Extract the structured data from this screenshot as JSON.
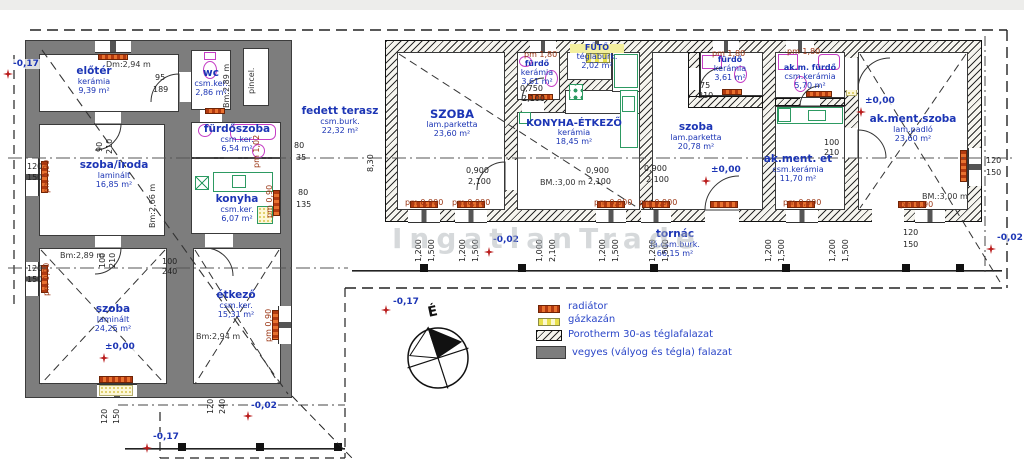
{
  "title": {
    "watermark": "IngatlanTrade",
    "north": "É"
  },
  "legend": {
    "radiator": "radiátor",
    "boiler": "gázkazán",
    "brick": "Porotherm 30-as téglafalazat",
    "mixed": "vegyes (vályog és tégla) falazat"
  },
  "rooms": {
    "eloter": {
      "name": "előtér",
      "mat": "kerámia",
      "area": "9,39 m²"
    },
    "wc": {
      "name": "wc",
      "mat": "csm.ker.",
      "area": "2,86 m²"
    },
    "pince": {
      "name": "pincel."
    },
    "furdoszoba": {
      "name": "fürdőszoba",
      "mat": "csm.ker.",
      "area": "6,54 m²"
    },
    "szoba_iroda": {
      "name": "szoba/iroda",
      "mat": "laminált",
      "area": "16,85 m²"
    },
    "konyha": {
      "name": "konyha",
      "mat": "csm.ker.",
      "area": "6,07 m²"
    },
    "szoba_nagy": {
      "name": "szoba",
      "mat": "laminált",
      "area": "24,25 m²"
    },
    "etkezo": {
      "name": "étkező",
      "mat": "csm.ker.",
      "area": "15,31 m²"
    },
    "szoba1": {
      "name": "SZOBA",
      "mat": "lam.parketta",
      "area": "23,60 m²"
    },
    "furdo1": {
      "name": "fürdő",
      "mat": "kerámia",
      "area": "3,61 m²"
    },
    "futo": {
      "name": "FŰTŐ",
      "mat": "téglaburk.",
      "area": "2,02 m²"
    },
    "konyha_etkezo": {
      "name": "KONYHA-ÉTKEZŐ",
      "mat": "kerámia",
      "area": "18,45 m²"
    },
    "szoba2": {
      "name": "szoba",
      "mat": "lam.parketta",
      "area": "20,78 m²"
    },
    "furdo2": {
      "name": "fürdő",
      "mat": "kerámia",
      "area": "3,61 m²"
    },
    "akm_furdo": {
      "name": "ak.m. fürdő",
      "mat": "csm.kerámia",
      "area": "5,70 m²"
    },
    "akment_et": {
      "name": "ak.ment. et",
      "mat": "csm.kerámia",
      "area": "11,70 m²"
    },
    "akment_szoba": {
      "name": "ak.ment.szoba",
      "mat": "lam.padló",
      "area": "23,60 m²"
    },
    "terasz": {
      "name": "fedett terasz",
      "mat": "csm.burk.",
      "area": "22,32 m²"
    },
    "tornac": {
      "name": "tornác",
      "mat": "fá.csm.burk.",
      "area": "66,15 m²"
    }
  },
  "heights": {
    "dm294": "Dm:2,94 m",
    "bm289": "Bm:2,89 m",
    "bm266": "Bm:2,66 m",
    "bm289b": "Bm:2,89 m",
    "bm294": "Bm:2,94 m",
    "bm300": "BM.:3,00 m",
    "bm300b": "BM.:3,00 m"
  },
  "levels": {
    "zero": "±0,00",
    "m002": "-0,02",
    "m017": "-0,17"
  },
  "dims": {
    "pm0900": "pm 0,900",
    "pm180": "pm 1,80",
    "pm090": "pm 0,90",
    "pm102": "pm 1,02",
    "d0900": "0,900",
    "d2100": "2,100",
    "d0750": "0,750",
    "d1200": "1,200",
    "d1500": "1,500",
    "d1000": "1,000",
    "d120": "120",
    "d150": "150",
    "d240": "240",
    "d100": "100",
    "d210": "210",
    "d95": "95",
    "d189": "189",
    "d75": "75",
    "d90": "90",
    "d830": "8,30",
    "d80": "80",
    "d35": "35",
    "d135": "135"
  }
}
